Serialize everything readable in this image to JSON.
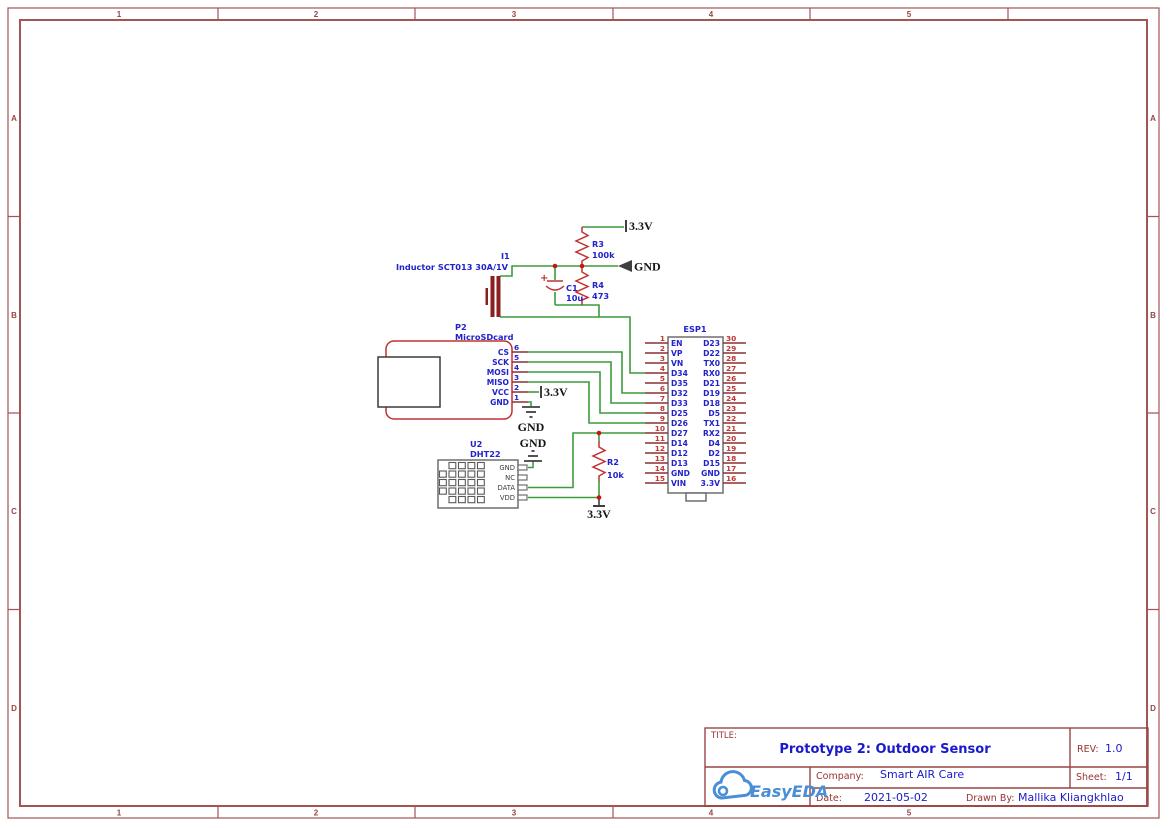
{
  "frame": {
    "columns": [
      "1",
      "2",
      "3",
      "4",
      "5"
    ],
    "rows": [
      "A",
      "B",
      "C",
      "D"
    ]
  },
  "title_block": {
    "title_label": "TITLE:",
    "title": "Prototype 2: Outdoor Sensor",
    "rev_label": "REV:",
    "rev": "1.0",
    "company_label": "Company:",
    "company": "Smart AIR Care",
    "sheet_label": "Sheet:",
    "sheet": "1/1",
    "date_label": "Date:",
    "date": "2021-05-02",
    "drawn_by_label": "Drawn By:",
    "drawn_by": "Mallika Kliangkhlao",
    "logo_text": "EasyEDA"
  },
  "net_flags": {
    "v33": "3.3V",
    "gnd": "GND"
  },
  "components": {
    "inductor": {
      "ref": "I1",
      "name": "Inductor SCT013 30A/1V"
    },
    "sdcard": {
      "ref": "P2",
      "name": "MicroSDcard",
      "pins": [
        {
          "num": "6",
          "name": "CS"
        },
        {
          "num": "5",
          "name": "SCK"
        },
        {
          "num": "4",
          "name": "MOSI"
        },
        {
          "num": "3",
          "name": "MISO"
        },
        {
          "num": "2",
          "name": "VCC"
        },
        {
          "num": "1",
          "name": "GND"
        }
      ]
    },
    "dht": {
      "ref": "U2",
      "name": "DHT22",
      "pins": [
        {
          "name": "GND"
        },
        {
          "name": "NC"
        },
        {
          "name": "DATA"
        },
        {
          "name": "VDD"
        }
      ]
    },
    "esp": {
      "ref": "ESP1",
      "left_pins": [
        {
          "num": "1",
          "name": "EN"
        },
        {
          "num": "2",
          "name": "VP"
        },
        {
          "num": "3",
          "name": "VN"
        },
        {
          "num": "4",
          "name": "D34"
        },
        {
          "num": "5",
          "name": "D35"
        },
        {
          "num": "6",
          "name": "D32"
        },
        {
          "num": "7",
          "name": "D33"
        },
        {
          "num": "8",
          "name": "D25"
        },
        {
          "num": "9",
          "name": "D26"
        },
        {
          "num": "10",
          "name": "D27"
        },
        {
          "num": "11",
          "name": "D14"
        },
        {
          "num": "12",
          "name": "D12"
        },
        {
          "num": "13",
          "name": "D13"
        },
        {
          "num": "14",
          "name": "GND"
        },
        {
          "num": "15",
          "name": "VIN"
        }
      ],
      "right_pins": [
        {
          "num": "30",
          "name": "D23"
        },
        {
          "num": "29",
          "name": "D22"
        },
        {
          "num": "28",
          "name": "TX0"
        },
        {
          "num": "27",
          "name": "RX0"
        },
        {
          "num": "26",
          "name": "D21"
        },
        {
          "num": "25",
          "name": "D19"
        },
        {
          "num": "24",
          "name": "D18"
        },
        {
          "num": "23",
          "name": "D5"
        },
        {
          "num": "22",
          "name": "TX1"
        },
        {
          "num": "21",
          "name": "RX2"
        },
        {
          "num": "20",
          "name": "D4"
        },
        {
          "num": "19",
          "name": "D2"
        },
        {
          "num": "18",
          "name": "D15"
        },
        {
          "num": "17",
          "name": "GND"
        },
        {
          "num": "16",
          "name": "3.3V"
        }
      ]
    },
    "r2": {
      "ref": "R2",
      "value": "10k"
    },
    "r3": {
      "ref": "R3",
      "value": "100k"
    },
    "r4": {
      "ref": "R4",
      "value": "473"
    },
    "c1": {
      "ref": "C1",
      "value": "10u",
      "polarity": "+"
    }
  },
  "colors": {
    "wire_green": "#3c9b3c",
    "component_red": "#c23030",
    "frame_brown": "#a35555",
    "label_blue": "#2222cc",
    "title_blue": "#1a1acc",
    "logo_blue": "#4a8fd6",
    "junction_red": "#cc1111",
    "netflag_dark": "#3f3f3f"
  }
}
